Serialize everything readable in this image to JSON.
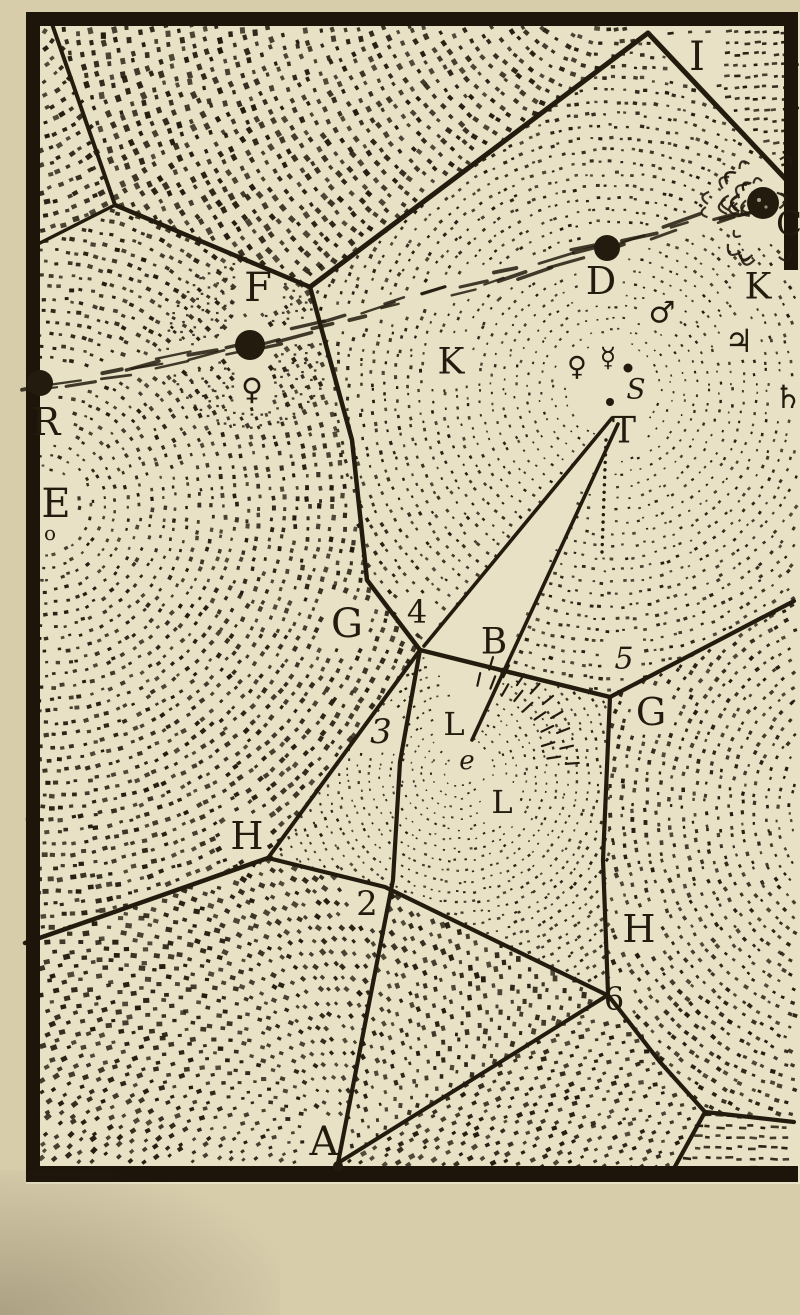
{
  "figure": {
    "colors": {
      "ink": "#231b0e",
      "paper_inner": "#e8e1c5",
      "paper_outer": "#d7cdab",
      "frame": "#1d150a"
    },
    "frame": {
      "x": 26,
      "y": 12,
      "w": 772,
      "h": 1170,
      "thickness": 14,
      "right_border_height": 258
    },
    "labels": [
      {
        "t": "I",
        "x": 697,
        "y": 57,
        "s": 40
      },
      {
        "t": "C",
        "x": 789,
        "y": 224,
        "s": 34
      },
      {
        "t": "K",
        "x": 758,
        "y": 287,
        "s": 36
      },
      {
        "t": "D",
        "x": 601,
        "y": 281,
        "s": 38
      },
      {
        "t": "F",
        "x": 258,
        "y": 288,
        "s": 40
      },
      {
        "t": "K",
        "x": 451,
        "y": 362,
        "s": 36
      },
      {
        "t": "R",
        "x": 46,
        "y": 422,
        "s": 38
      },
      {
        "t": "E",
        "x": 56,
        "y": 504,
        "s": 40
      },
      {
        "t": "o",
        "x": 50,
        "y": 533,
        "s": 20
      },
      {
        "t": "♀",
        "x": 252,
        "y": 390,
        "s": 30,
        "f": "sym"
      },
      {
        "t": "♀",
        "x": 577,
        "y": 367,
        "s": 27,
        "f": "sym"
      },
      {
        "t": "☿",
        "x": 608,
        "y": 358,
        "s": 27,
        "f": "sym"
      },
      {
        "t": "S",
        "x": 636,
        "y": 389,
        "s": 28,
        "it": 1
      },
      {
        "t": "♂",
        "x": 662,
        "y": 313,
        "s": 30,
        "f": "sym"
      },
      {
        "t": "♃",
        "x": 739,
        "y": 341,
        "s": 32,
        "f": "sym"
      },
      {
        "t": "♄",
        "x": 788,
        "y": 397,
        "s": 32,
        "f": "sym"
      },
      {
        "t": "T",
        "x": 624,
        "y": 431,
        "s": 36
      },
      {
        "t": "G",
        "x": 347,
        "y": 624,
        "s": 40
      },
      {
        "t": "4",
        "x": 417,
        "y": 612,
        "s": 32
      },
      {
        "t": "B",
        "x": 494,
        "y": 642,
        "s": 36
      },
      {
        "t": "5",
        "x": 624,
        "y": 659,
        "s": 30,
        "it": 1
      },
      {
        "t": "G",
        "x": 651,
        "y": 712,
        "s": 38
      },
      {
        "t": "3",
        "x": 381,
        "y": 732,
        "s": 34,
        "it": 1
      },
      {
        "t": "L",
        "x": 454,
        "y": 724,
        "s": 32
      },
      {
        "t": "e",
        "x": 467,
        "y": 761,
        "s": 26,
        "it": 1
      },
      {
        "t": "L",
        "x": 502,
        "y": 802,
        "s": 32
      },
      {
        "t": "H",
        "x": 247,
        "y": 836,
        "s": 38
      },
      {
        "t": "2",
        "x": 367,
        "y": 904,
        "s": 34
      },
      {
        "t": "H",
        "x": 639,
        "y": 929,
        "s": 38
      },
      {
        "t": "6",
        "x": 614,
        "y": 999,
        "s": 32
      },
      {
        "t": "A",
        "x": 324,
        "y": 1142,
        "s": 40
      }
    ],
    "lines": [
      {
        "pts": [
          [
            52,
            24
          ],
          [
            115,
            205
          ]
        ],
        "w": 4
      },
      {
        "pts": [
          [
            115,
            205
          ],
          [
            40,
            243
          ]
        ],
        "w": 3.5
      },
      {
        "pts": [
          [
            115,
            205
          ],
          [
            310,
            287
          ]
        ],
        "w": 4.5
      },
      {
        "pts": [
          [
            310,
            287
          ],
          [
            648,
            33
          ]
        ],
        "w": 5
      },
      {
        "pts": [
          [
            648,
            33
          ],
          [
            794,
            188
          ]
        ],
        "w": 5
      },
      {
        "pts": [
          [
            310,
            287
          ],
          [
            352,
            440
          ],
          [
            367,
            580
          ],
          [
            420,
            650
          ]
        ],
        "w": 4.5
      },
      {
        "pts": [
          [
            612,
            418
          ],
          [
            424,
            646
          ]
        ],
        "w": 3.6
      },
      {
        "pts": [
          [
            618,
            424
          ],
          [
            472,
            740
          ]
        ],
        "w": 3.6
      },
      {
        "pts": [
          [
            420,
            650
          ],
          [
            610,
            697
          ]
        ],
        "w": 4.5
      },
      {
        "pts": [
          [
            610,
            697
          ],
          [
            794,
            601
          ]
        ],
        "w": 4.2
      },
      {
        "pts": [
          [
            610,
            697
          ],
          [
            603,
            860
          ],
          [
            608,
            993
          ]
        ],
        "w": 4.2
      },
      {
        "pts": [
          [
            420,
            650
          ],
          [
            400,
            762
          ],
          [
            393,
            880
          ],
          [
            338,
            1163
          ]
        ],
        "w": 4.2
      },
      {
        "pts": [
          [
            268,
            858
          ],
          [
            385,
            887
          ],
          [
            607,
            995
          ]
        ],
        "w": 4.2
      },
      {
        "pts": [
          [
            268,
            858
          ],
          [
            420,
            650
          ]
        ],
        "w": 4
      },
      {
        "pts": [
          [
            268,
            858
          ],
          [
            100,
            917
          ],
          [
            25,
            943
          ]
        ],
        "w": 4.5
      },
      {
        "pts": [
          [
            338,
            1163
          ],
          [
            608,
            995
          ]
        ],
        "w": 4
      },
      {
        "pts": [
          [
            608,
            995
          ],
          [
            660,
            1062
          ],
          [
            705,
            1112
          ]
        ],
        "w": 4.2
      },
      {
        "pts": [
          [
            705,
            1112
          ],
          [
            672,
            1172
          ]
        ],
        "w": 4.2
      },
      {
        "pts": [
          [
            705,
            1112
          ],
          [
            794,
            1122
          ]
        ],
        "w": 4.2
      }
    ],
    "dotted_line": {
      "from": [
        606,
        440
      ],
      "to": [
        602,
        552
      ]
    },
    "wedge": [
      [
        612,
        418
      ],
      [
        424,
        646
      ],
      [
        472,
        740
      ]
    ],
    "comet": {
      "path": [
        [
          28,
          390
        ],
        [
          250,
          345
        ],
        [
          607,
          248
        ],
        [
          763,
          203
        ]
      ],
      "star_dots": [
        [
          40,
          383,
          13
        ],
        [
          250,
          345,
          15
        ],
        [
          607,
          248,
          13
        ]
      ],
      "small_dots": [
        [
          628,
          368,
          4.5
        ],
        [
          610,
          402,
          4
        ],
        [
          338,
          1166,
          5
        ]
      ],
      "head": {
        "x": 763,
        "y": 203,
        "r": 16
      }
    },
    "f_star_rings": {
      "cx": 250,
      "cy": 345,
      "r0": 34,
      "r1": 86
    },
    "e_vortex_strokes": {
      "cx": 458,
      "cy": 772
    },
    "stipple_cells": [
      {
        "name": "top-left-corner",
        "poly": [
          [
            40,
            24
          ],
          [
            56,
            24
          ],
          [
            118,
            206
          ],
          [
            40,
            246
          ]
        ],
        "cx": -20,
        "cy": -20,
        "r0": 70,
        "r1": 340,
        "ring": 12.5,
        "step": 10.5,
        "s0": 4,
        "s1": 5.2
      },
      {
        "name": "top-vortex",
        "poly": [
          [
            56,
            24
          ],
          [
            652,
            28
          ],
          [
            310,
            287
          ],
          [
            118,
            206
          ]
        ],
        "cx": 610,
        "cy": -45,
        "r0": 75,
        "r1": 610,
        "ring": 12.5,
        "step": 11,
        "s0": 4.2,
        "s1": 5.2
      },
      {
        "name": "top-right-corner",
        "poly": [
          [
            658,
            28
          ],
          [
            796,
            28
          ],
          [
            796,
            184
          ]
        ],
        "mode": "rows",
        "rowStep": 11,
        "dashW": 5,
        "dashH": 2.6,
        "tilt": -6
      },
      {
        "name": "left-vortex-E",
        "poly": [
          [
            40,
            246
          ],
          [
            118,
            206
          ],
          [
            310,
            287
          ],
          [
            367,
            580
          ],
          [
            420,
            650
          ],
          [
            268,
            858
          ],
          [
            25,
            943
          ]
        ],
        "cx": 42,
        "cy": 505,
        "r0": 26,
        "r1": 640,
        "ring": 12,
        "step": 10.5,
        "s0": 3,
        "s1": 5.4
      },
      {
        "name": "sun-vortex-S",
        "poly": [
          [
            310,
            287
          ],
          [
            648,
            33
          ],
          [
            796,
            186
          ],
          [
            796,
            602
          ],
          [
            610,
            697
          ],
          [
            420,
            650
          ],
          [
            367,
            580
          ]
        ],
        "cx": 612,
        "cy": 390,
        "r0": 48,
        "r1": 580,
        "ring": 12,
        "step": 10,
        "s0": 2,
        "s1": 4.8
      },
      {
        "name": "e-vortex",
        "poly": [
          [
            420,
            650
          ],
          [
            610,
            697
          ],
          [
            608,
            995
          ],
          [
            385,
            887
          ],
          [
            268,
            858
          ]
        ],
        "cx": 458,
        "cy": 772,
        "r0": 15,
        "r1": 290,
        "ring": 10.5,
        "step": 8.5,
        "s0": 1.7,
        "s1": 3.4
      },
      {
        "name": "right-vortex-G",
        "poly": [
          [
            610,
            697
          ],
          [
            796,
            602
          ],
          [
            796,
            1122
          ],
          [
            705,
            1112
          ],
          [
            608,
            995
          ]
        ],
        "cx": 880,
        "cy": 810,
        "r0": 90,
        "r1": 470,
        "ring": 12,
        "step": 10,
        "s0": 3,
        "s1": 4.6
      },
      {
        "name": "bottom-vortex-A",
        "poly": [
          [
            40,
            943
          ],
          [
            268,
            858
          ],
          [
            385,
            887
          ],
          [
            607,
            995
          ],
          [
            338,
            1163
          ],
          [
            40,
            1164
          ]
        ],
        "cx": 335,
        "cy": 1170,
        "r0": 30,
        "r1": 470,
        "ring": 12.5,
        "step": 10.5,
        "s0": 3.4,
        "s1": 5.6,
        "r45": 1
      },
      {
        "name": "bottom-sliver",
        "poly": [
          [
            608,
            995
          ],
          [
            705,
            1112
          ],
          [
            672,
            1172
          ],
          [
            338,
            1165
          ]
        ],
        "cx": 940,
        "cy": 1260,
        "r0": 240,
        "r1": 660,
        "ring": 12,
        "step": 10,
        "s0": 3.6,
        "s1": 4.6,
        "r45": 1
      },
      {
        "name": "bottom-right-corner",
        "poly": [
          [
            705,
            1112
          ],
          [
            796,
            1122
          ],
          [
            796,
            1168
          ],
          [
            672,
            1172
          ]
        ],
        "mode": "rows",
        "rowStep": 10.5,
        "dashW": 6.5,
        "dashH": 2.6,
        "tilt": 2
      }
    ]
  }
}
